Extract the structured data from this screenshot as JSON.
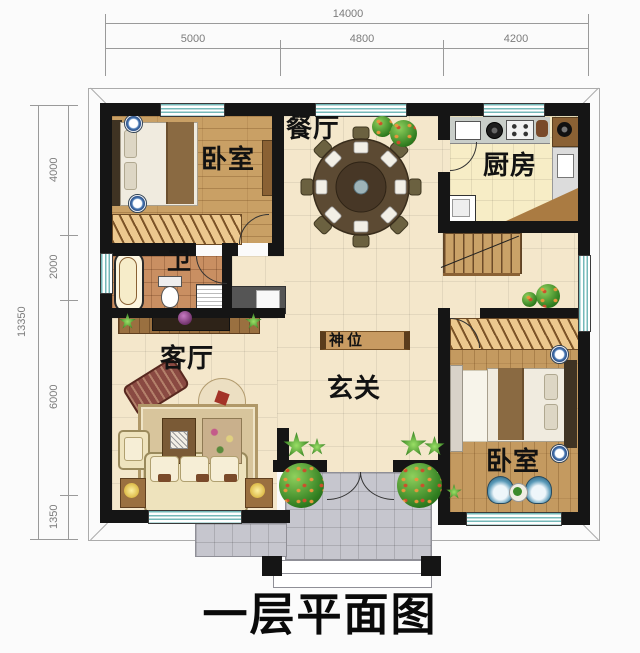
{
  "title": "一层平面图",
  "dims": {
    "top_total": "14000",
    "top_segs": [
      "5000",
      "4800",
      "4200"
    ],
    "left_total": "13350",
    "left_segs": [
      "4000",
      "2000",
      "6000",
      "1350"
    ]
  },
  "rooms": {
    "bedroom_nw": "卧室",
    "dining": "餐厅",
    "kitchen": "厨房",
    "bathroom": "卫",
    "living": "客厅",
    "shrine": "神位",
    "foyer": "玄关",
    "bedroom_se": "卧室"
  },
  "colors": {
    "wall": "#151515",
    "window_stripe": "#74b9b9",
    "wood_floor": "#c9a065",
    "tile_floor": "#f4e7cb",
    "kitchen_floor": "#f7edc6",
    "bath_floor": "#c98f62",
    "porch_floor": "#c6c6ce",
    "dim_text": "#7c7c7c",
    "label_text": "#121212"
  }
}
